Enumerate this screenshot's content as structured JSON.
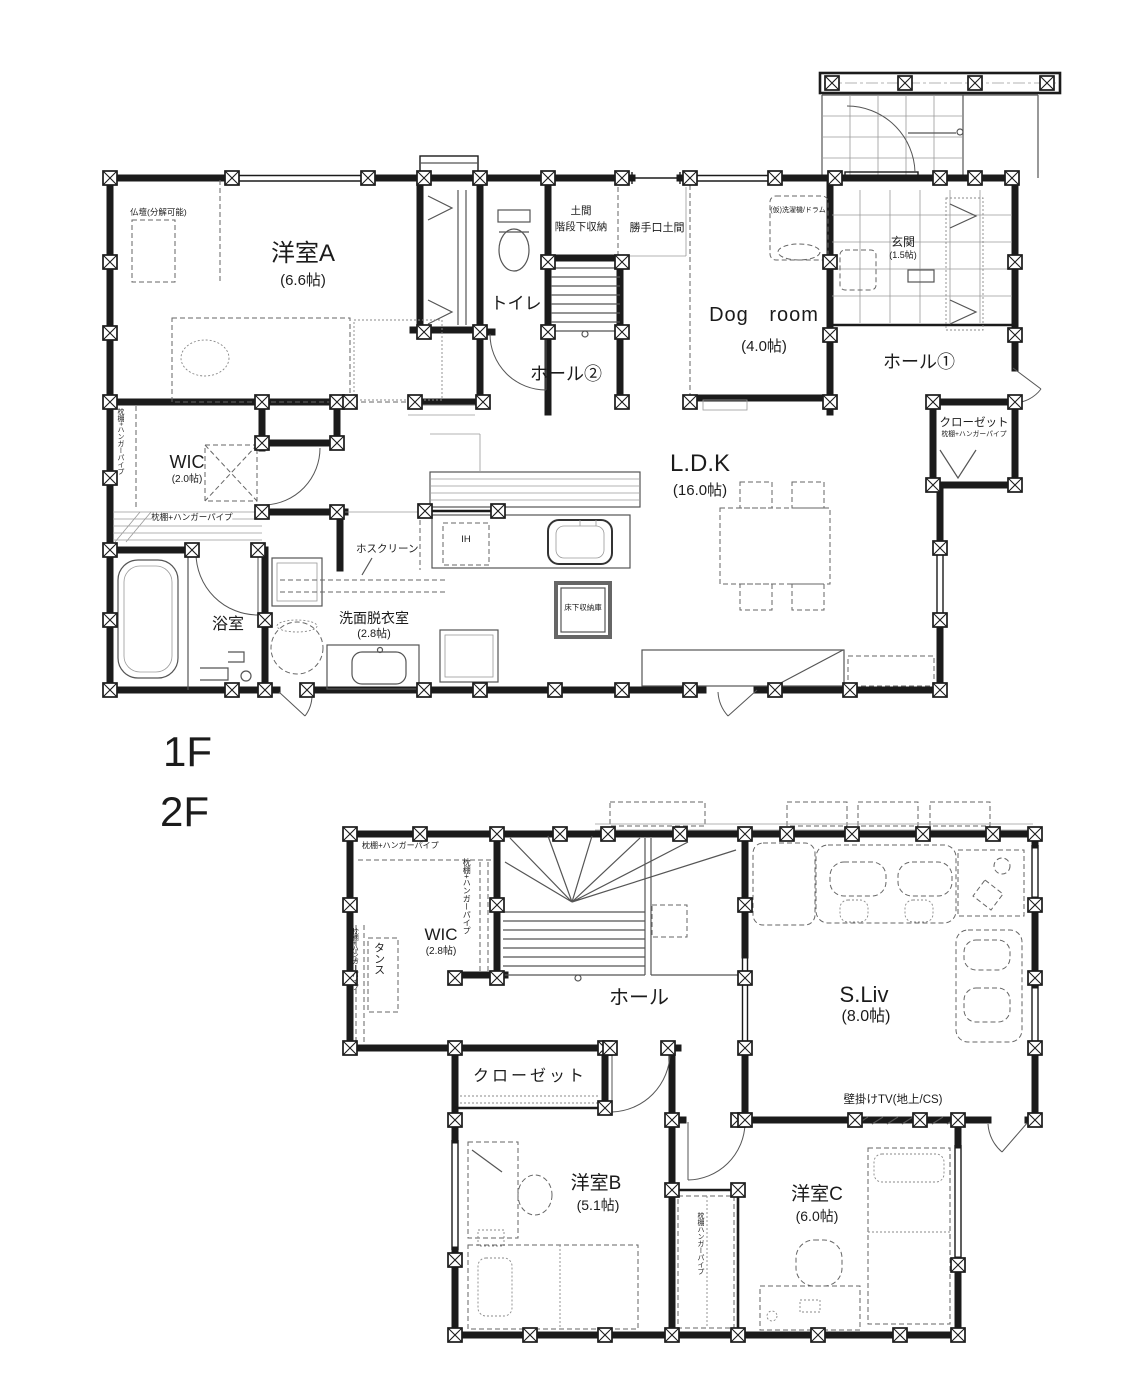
{
  "floor1": {
    "label": "1F",
    "rooms": {
      "a": {
        "name": "洋室A",
        "size": "(6.6帖)"
      },
      "toilet": {
        "name": "トイレ"
      },
      "hall2": {
        "name": "ホール②"
      },
      "dog": {
        "name": "Dog room",
        "size": "(4.0帖)"
      },
      "genkan": {
        "name": "玄関",
        "size": "(1.5帖)"
      },
      "hall1": {
        "name": "ホール①"
      },
      "wic": {
        "name": "WIC",
        "size": "(2.0帖)"
      },
      "ldk": {
        "name": "L.D.K",
        "size": "(16.0帖)"
      },
      "bath": {
        "name": "浴室"
      },
      "senmen": {
        "name": "洗面脱衣室",
        "size": "(2.8帖)"
      }
    },
    "ann": {
      "butsudan": "仏壇(分解可能)",
      "doma1": "土間",
      "doma2": "階段下収納",
      "katteguchi": "勝手口土間",
      "washer": "(仮)洗濯機/ドラム",
      "closet": "クローゼット",
      "closet_shelf": "枕棚+ハンガーパイプ",
      "wic_pipe_left": "枕棚+ハンガーパイプ",
      "wic_pipe_bottom": "枕棚+ハンガーパイプ",
      "hosclean": "ホスクリーン",
      "ih": "IH",
      "yukashita": "床下収納庫"
    }
  },
  "floor2": {
    "label": "2F",
    "rooms": {
      "wic": {
        "name": "WIC",
        "size": "(2.8帖)"
      },
      "hall": {
        "name": "ホール"
      },
      "sliv": {
        "name": "S.Liv",
        "size": "(8.0帖)"
      },
      "closet": {
        "name": "クローゼット"
      },
      "b": {
        "name": "洋室B",
        "size": "(5.1帖)"
      },
      "c": {
        "name": "洋室C",
        "size": "(6.0帖)"
      }
    },
    "ann": {
      "wic_shelf_top": "枕棚+ハンガーパイプ",
      "wic_shelf_right": "枕棚+ハンガーパイプ",
      "wic_shelf_left": "枕棚+ハンガーパイプ",
      "tansu": "タンス",
      "tv": "壁掛けTV(地上/CS)",
      "closet_c_shelf": "枕棚ハンガーパイプ"
    }
  }
}
